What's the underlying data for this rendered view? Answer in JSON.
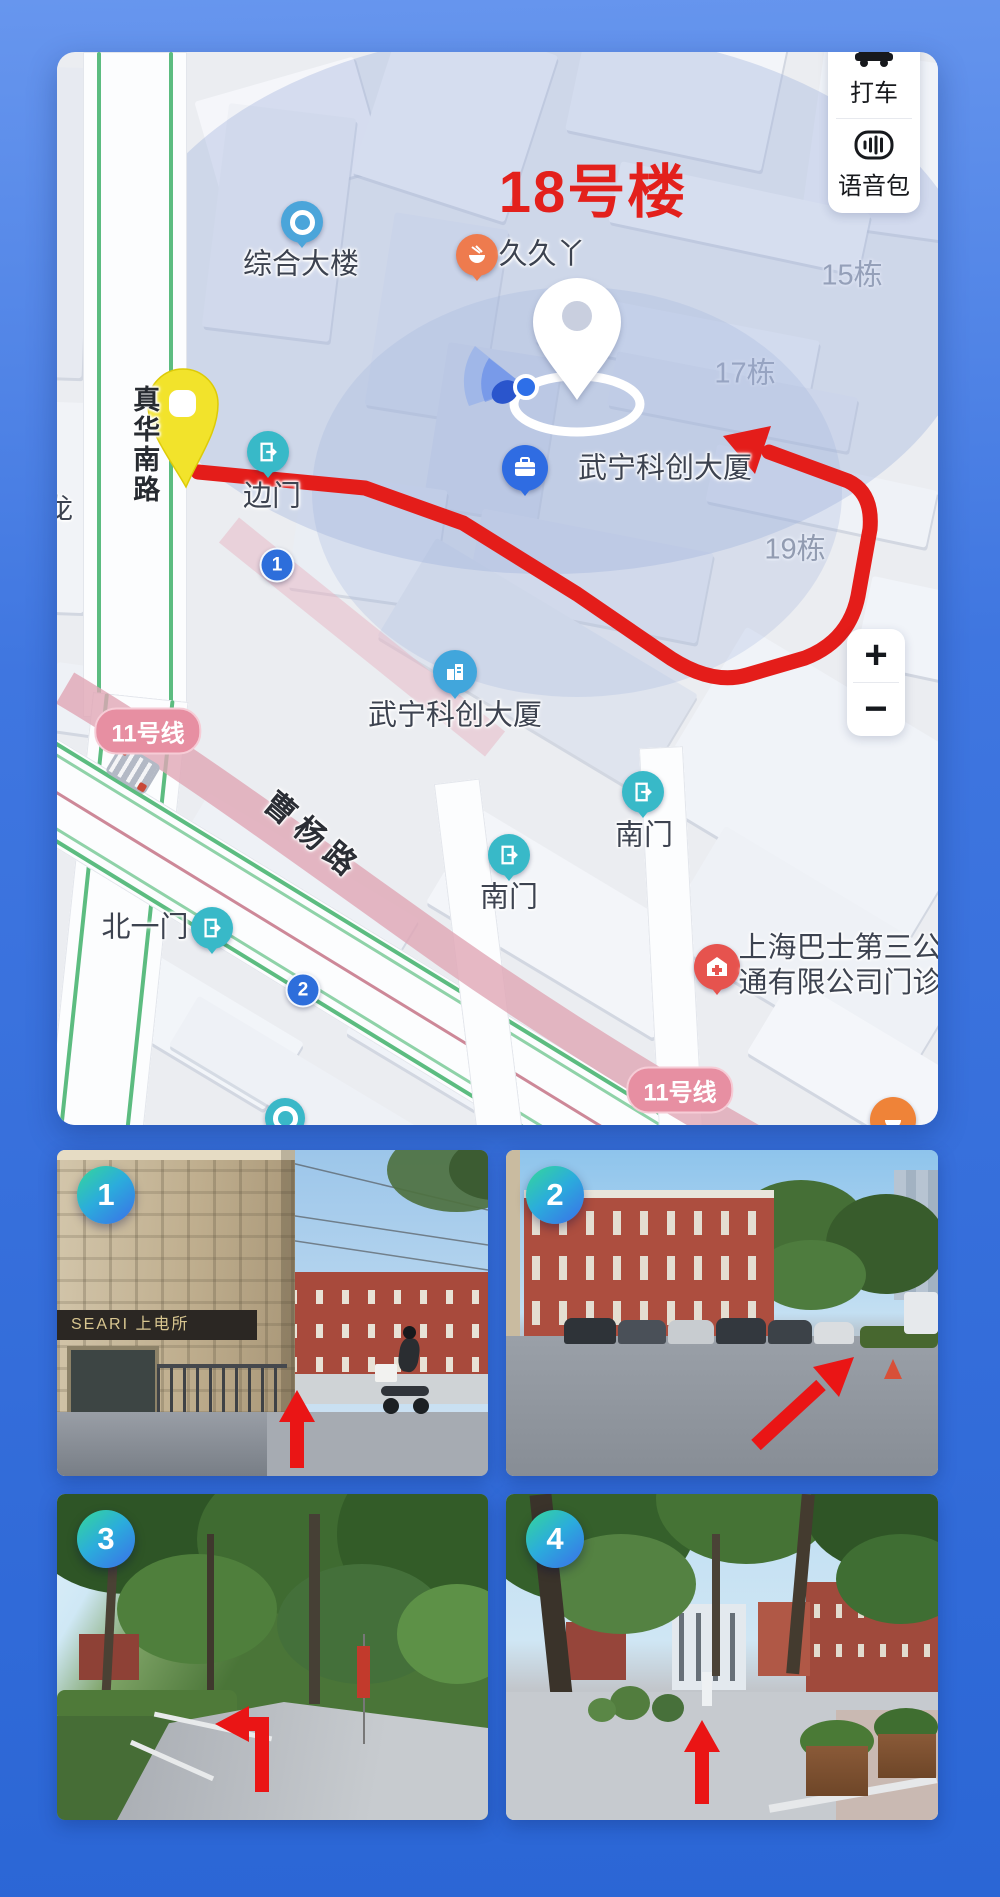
{
  "accent": {
    "route_red": "#e4201c",
    "background_blue": "#3c73de",
    "badge_gradient": [
      "#35d898",
      "#3b6ee8"
    ]
  },
  "map": {
    "side_panel": {
      "taxi_label": "打车",
      "voice_pack_label": "语音包"
    },
    "zoom_control": {
      "zoom_in": "+",
      "zoom_out": "−"
    },
    "destination_title": "18号楼",
    "pois": {
      "office_building": "综合大楼",
      "snack_shop": "久久丫",
      "building_15": "15栋",
      "building_17": "17栋",
      "building_19": "19栋",
      "wuning_tower": "武宁科创大厦",
      "side_gate": "边门",
      "south_gate": "南门",
      "north_gate_1": "北一门",
      "clinic_line1": "上海巴士第三公",
      "clinic_line2": "通有限公司门诊",
      "edge_partial": "龙"
    },
    "roads": {
      "zhenhua_south_road": "真华南路",
      "caoyang_road": "曹杨路",
      "metro_line11": "11号线"
    },
    "waypoints": {
      "w1": "1",
      "w2": "2"
    }
  },
  "photos": [
    {
      "number": "1",
      "sign_text": "SEARI 上电所"
    },
    {
      "number": "2"
    },
    {
      "number": "3"
    },
    {
      "number": "4"
    }
  ]
}
